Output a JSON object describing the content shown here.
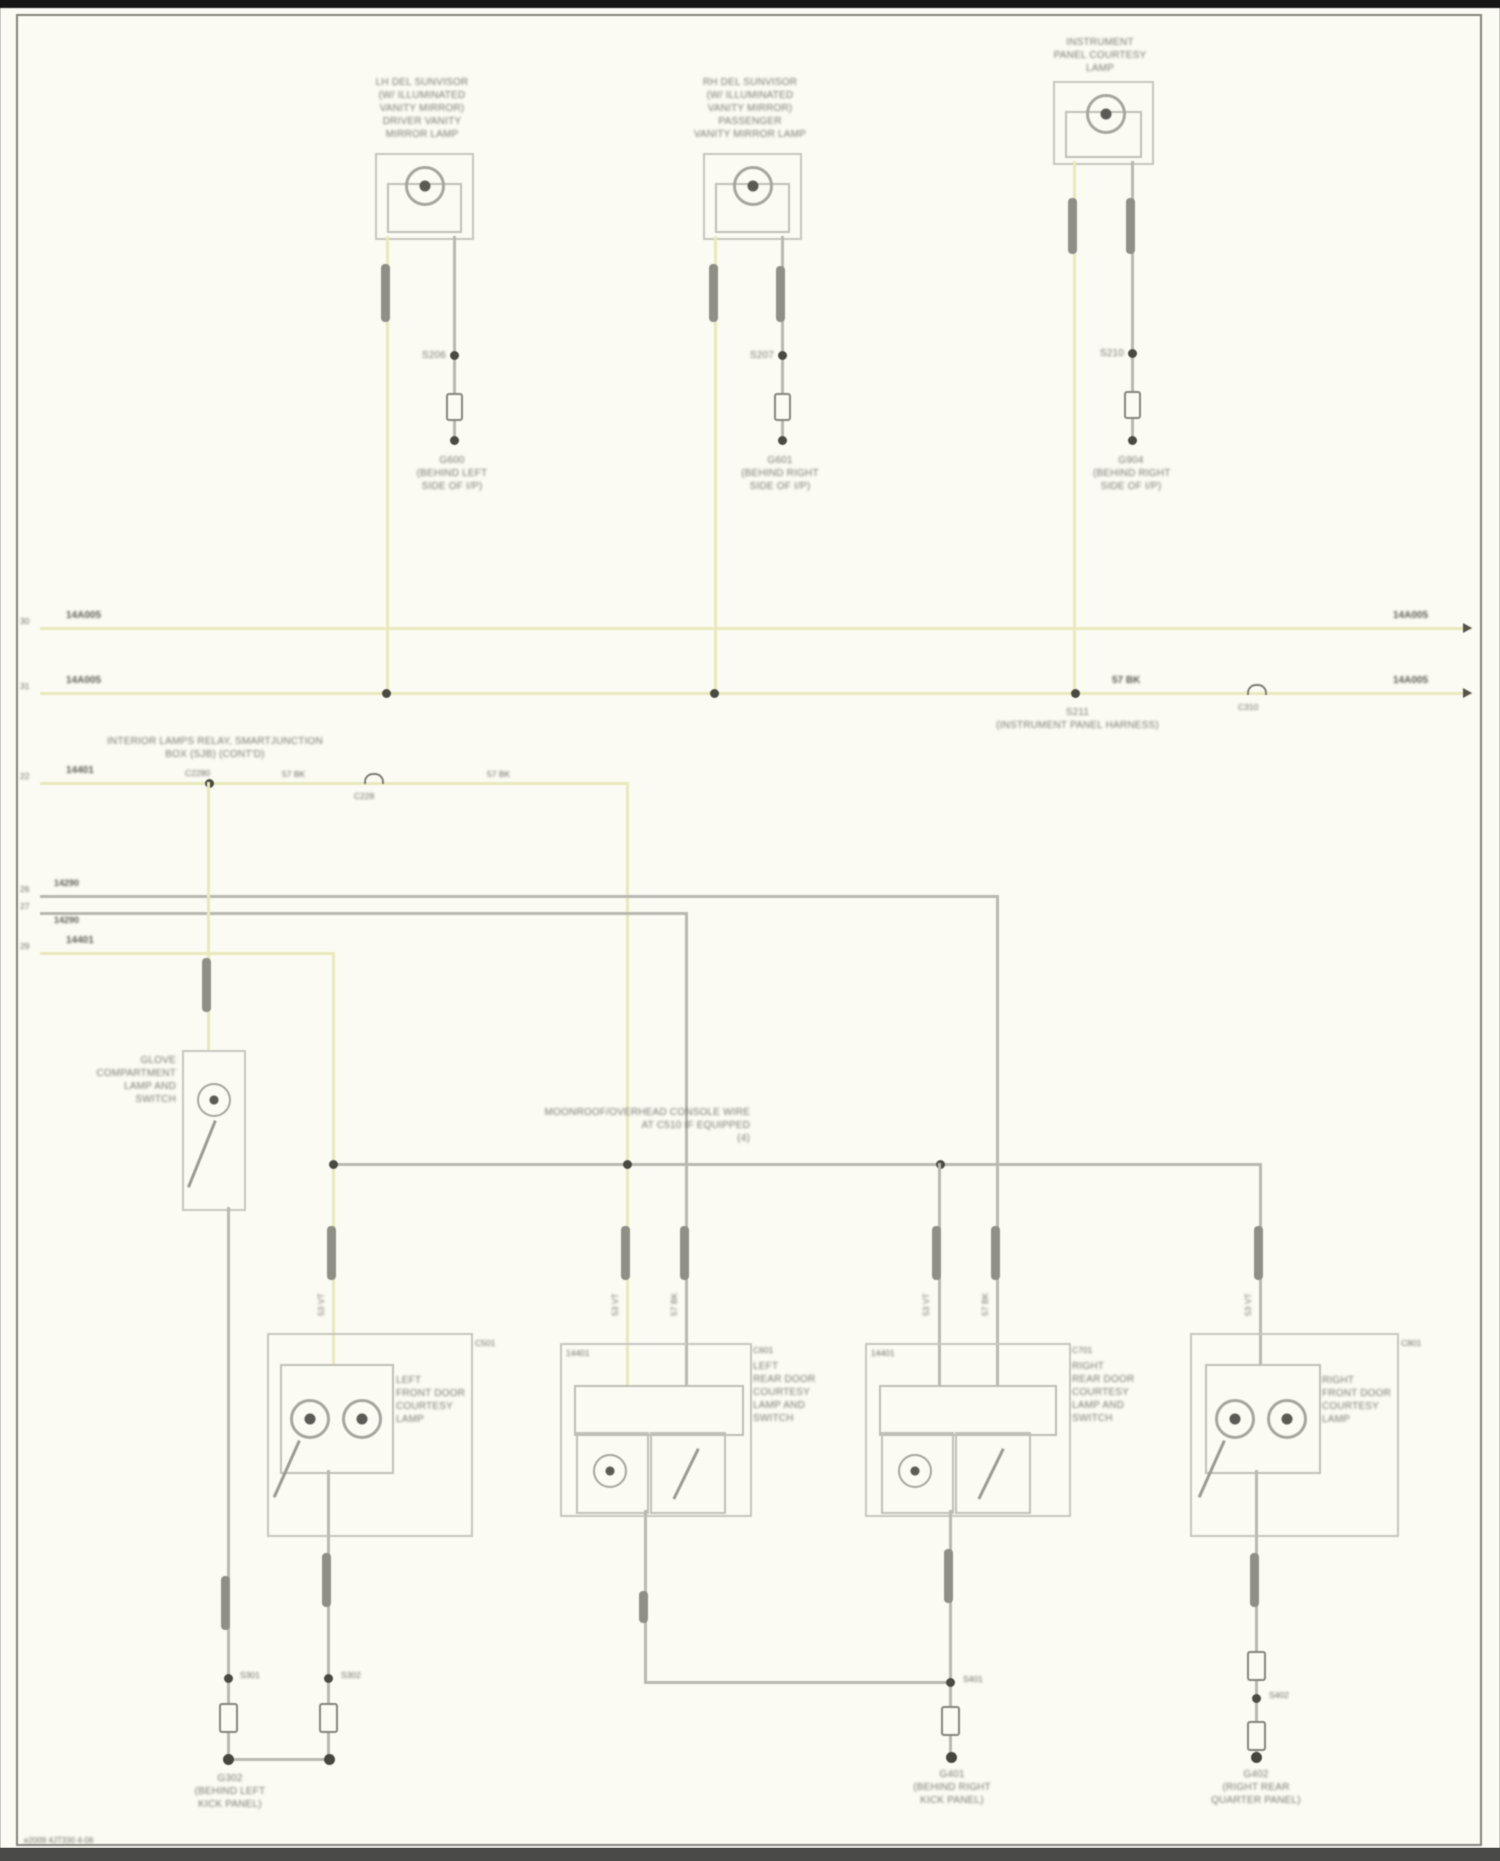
{
  "footer": {
    "code": "e2009 4JT330 4-06"
  },
  "circuits": {
    "c1": {
      "lines": [
        "LH DEL SUNVISOR",
        "(W/ ILLUMINATED",
        "VANITY MIRROR)",
        "DRIVER VANITY",
        "MIRROR LAMP"
      ],
      "splice": "S206",
      "gnd": [
        "G600",
        "(BEHIND LEFT",
        "SIDE OF I/P)"
      ]
    },
    "c2": {
      "lines": [
        "RH DEL SUNVISOR",
        "(W/ ILLUMINATED",
        "VANITY MIRROR)",
        "PASSENGER",
        "VANITY MIRROR LAMP"
      ],
      "splice": "S207",
      "gnd": [
        "G601",
        "(BEHIND RIGHT",
        "SIDE OF I/P)"
      ]
    },
    "c3": {
      "lines": [
        "INSTRUMENT",
        "PANEL COURTESY",
        "LAMP"
      ],
      "splice": "S210",
      "gnd": [
        "G904",
        "(BEHIND RIGHT",
        "SIDE OF I/P)"
      ]
    }
  },
  "buses": {
    "bus1": {
      "lcode": "14A005",
      "rcode": "14A005",
      "ltick": "30",
      "rtick": "30"
    },
    "bus2": {
      "lcode": "14A005",
      "rcode": "14A005",
      "ltick": "31",
      "rtick": "31",
      "wire": "57 BK",
      "splice": "S211",
      "splice_loc": "(INSTRUMENT PANEL HARNESS)",
      "conn": "C310"
    }
  },
  "rails": {
    "r3": {
      "owner1": "INTERIOR LAMPS RELAY, SMARTJUNCTION",
      "owner2": "BOX (SJB) (CONT'D)",
      "code": "14401",
      "fuse": "C2280",
      "wirea": "57 BK",
      "wireb": "57 BK",
      "conn": "C228",
      "tick": "22"
    },
    "ra": {
      "code": "14290",
      "tick": "26"
    },
    "rb": {
      "code": "14290",
      "tick": "27"
    },
    "r4": {
      "code": "14401",
      "tick": "29"
    }
  },
  "note": {
    "l1": "MOONROOF/OVERHEAD CONSOLE WIRE",
    "l2": "AT C510 IF EQUIPPED",
    "l3": "(4)"
  },
  "glove": {
    "lines": [
      "GLOVE",
      "COMPARTMENT",
      "LAMP AND",
      "SWITCH"
    ],
    "splice": "S301"
  },
  "asm": {
    "a1": {
      "conn": "C501",
      "lines": [
        "LEFT",
        "FRONT DOOR",
        "COURTESY",
        "LAMP"
      ],
      "splice": "S302",
      "wire": "53 VT"
    },
    "a2": {
      "conn": "C601",
      "inlbl": "14401",
      "lines": [
        "LEFT",
        "REAR DOOR",
        "COURTESY",
        "LAMP AND",
        "SWITCH"
      ],
      "wirea": "53 VT",
      "wireb": "57 BK"
    },
    "a3": {
      "conn": "C701",
      "inlbl": "14401",
      "lines": [
        "RIGHT",
        "REAR DOOR",
        "COURTESY",
        "LAMP AND",
        "SWITCH"
      ],
      "splice": "S401",
      "wirea": "53 VT",
      "wireb": "57 BK"
    },
    "a4": {
      "conn": "C801",
      "lines": [
        "RIGHT",
        "FRONT DOOR",
        "COURTESY",
        "LAMP"
      ],
      "splice": "S402",
      "wire": "53 VT"
    }
  },
  "grounds": {
    "left": [
      "G302",
      "(BEHIND LEFT",
      "KICK PANEL)"
    ],
    "mid": [
      "G401",
      "(BEHIND RIGHT",
      "KICK PANEL)"
    ],
    "right": [
      "G402",
      "(RIGHT REAR",
      "QUARTER PANEL)"
    ]
  }
}
